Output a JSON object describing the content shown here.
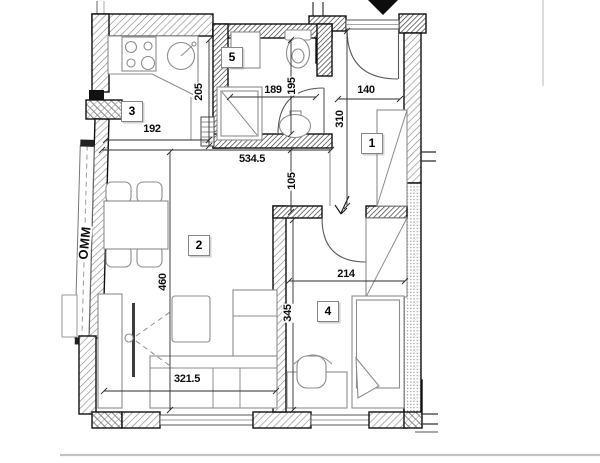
{
  "drawing": {
    "rooms": {
      "hall": {
        "number": "1"
      },
      "living": {
        "number": "2"
      },
      "kitchen": {
        "number": "3"
      },
      "bedroom": {
        "number": "4"
      },
      "bathroom": {
        "number": "5"
      }
    },
    "dimensions": {
      "kitchen_depth": "205",
      "kitchen_width": "192",
      "bath_width": "189",
      "bath_depth": "195",
      "entry_width": "140",
      "hall_depth": "310",
      "living_width": "534.5",
      "passage_width": "105",
      "living_depth": "460",
      "bedroom_width": "214",
      "bedroom_depth": "345",
      "sofa_wall": "321.5"
    },
    "labels": {
      "window_mark": "OMM"
    },
    "colors": {
      "wall_outline": "#101010",
      "hatch": "#8c8c8c",
      "furniture_line": "#8d8d8d",
      "dimension_line": "#2e2e2e",
      "background": "#ffffff"
    }
  }
}
